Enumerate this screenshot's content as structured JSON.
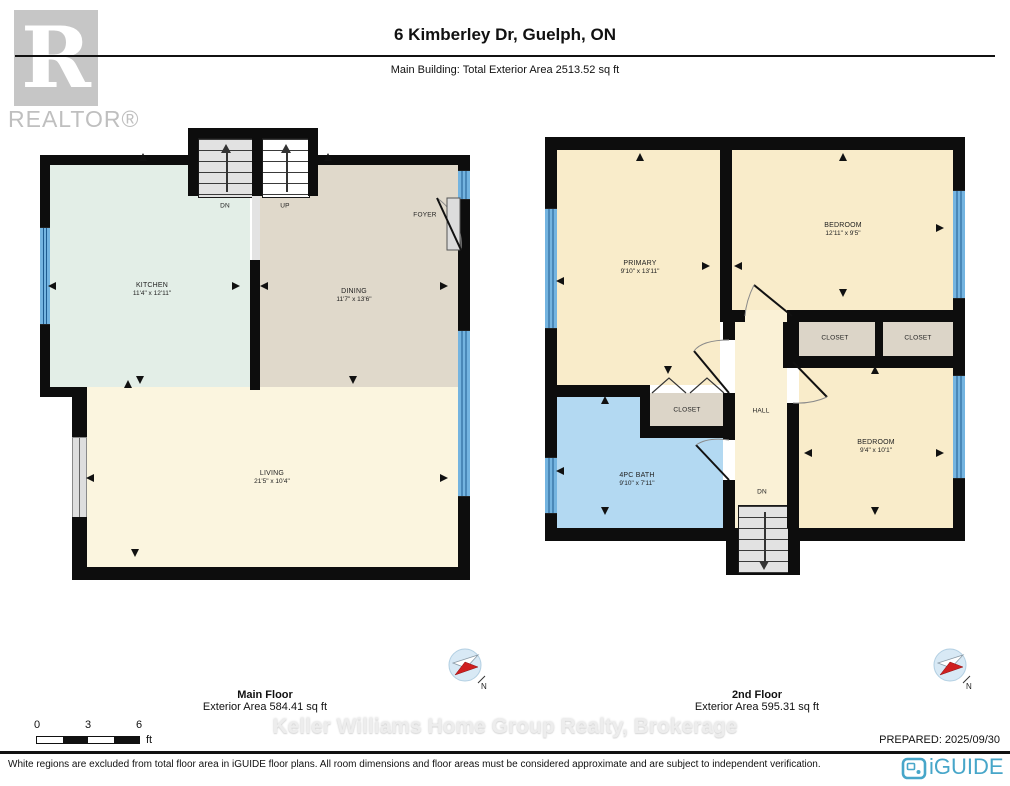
{
  "header": {
    "logo_letter": "R",
    "logo_text": "REALTOR®",
    "title": "6 Kimberley Dr, Guelph, ON",
    "subtitle": "Main Building: Total Exterior Area 2513.52 sq ft"
  },
  "main_floor": {
    "title": "Main Floor",
    "area": "Exterior Area 584.41 sq ft",
    "kitchen_name": "KITCHEN",
    "kitchen_dims": "11'4\" x 12'11\"",
    "dining_name": "DINING",
    "dining_dims": "11'7\" x 13'6\"",
    "living_name": "LIVING",
    "living_dims": "21'5\" x 10'4\"",
    "foyer_name": "FOYER",
    "stairs_down": "DN",
    "stairs_up": "UP"
  },
  "second_floor": {
    "title": "2nd Floor",
    "area": "Exterior Area 595.31 sq ft",
    "primary_name": "PRIMARY",
    "primary_dims": "9'10\" x 13'11\"",
    "bedroom1_name": "BEDROOM",
    "bedroom1_dims": "12'11\" x 9'5\"",
    "bedroom2_name": "BEDROOM",
    "bedroom2_dims": "9'4\" x 10'1\"",
    "bath_name": "4PC BATH",
    "bath_dims": "9'10\" x 7'11\"",
    "closet1_name": "CLOSET",
    "closet2_name": "CLOSET",
    "closet3_name": "CLOSET",
    "hall_name": "HALL",
    "stairs_down": "DN"
  },
  "footer": {
    "watermark": "Keller Williams Home Group Realty, Brokerage",
    "prepared": "PREPARED: 2025/09/30",
    "disclaimer": "White regions are excluded from total floor area in iGUIDE floor plans. All room dimensions and floor areas must be considered approximate and are subject to independent verification.",
    "brand": "iGUIDE",
    "compass_n": "N",
    "scale": {
      "zero": "0",
      "three": "3",
      "six": "6",
      "unit": "ft"
    }
  },
  "colors": {
    "kitchen": "#e3eee7",
    "dining": "#e0d9cb",
    "living": "#fbf5df",
    "bedroom": "#f9ecca",
    "hall": "#faf1d6",
    "bath": "#b3d9f2",
    "closet": "#dcd5c8",
    "stair": "#e2e2e2",
    "stair_up": "#ffffff",
    "window": "#74b4e0",
    "wall": "#0d0d0d",
    "brand_blue": "#47a6c9"
  }
}
